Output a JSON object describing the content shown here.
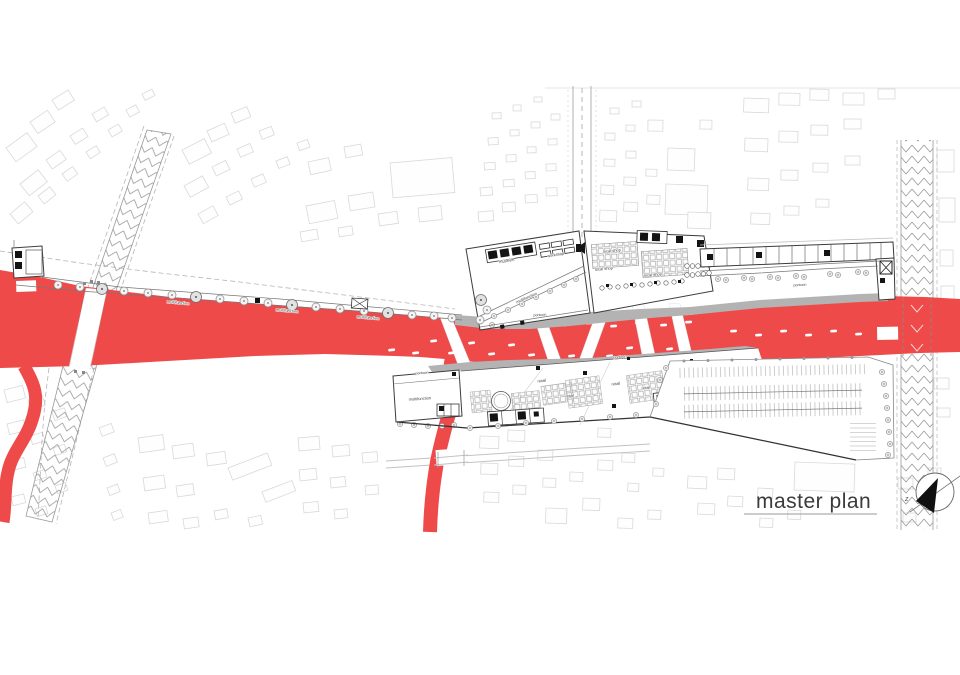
{
  "title": {
    "text": "master plan"
  },
  "compass": {
    "mark": "z"
  },
  "labels": {
    "multifunction": "multifunction",
    "local_shop": "local shop",
    "retail": "retail",
    "museum": "museum",
    "workshop": "workshop",
    "pontoon": "pontoon"
  },
  "colors": {
    "river": "#ee4a4a",
    "embankment": "#b3b3b3",
    "context_line": "#d9d9d9",
    "design_line": "#3c3c3c"
  }
}
